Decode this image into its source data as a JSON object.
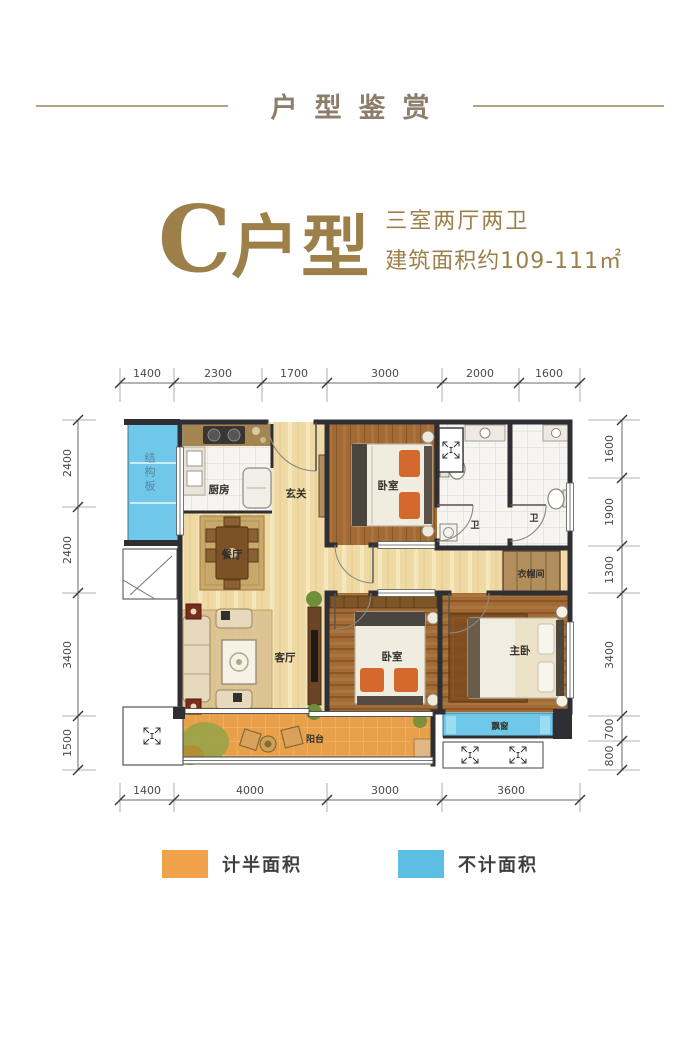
{
  "header": {
    "title": "户型鉴赏"
  },
  "unit": {
    "series": "C",
    "type_word": "户型",
    "layout": "三室两厅两卫",
    "area": "建筑面积约109-111㎡"
  },
  "plan": {
    "rooms": {
      "kitchen": "厨房",
      "foyer": "玄关",
      "dining": "餐厅",
      "living": "客厅",
      "bedroom1": "卧室",
      "bedroom2": "卧室",
      "master": "主卧",
      "bath1": "卫",
      "bath2": "卫",
      "closet": "衣帽间",
      "balcony": "阳台",
      "bay_window": "飘窗",
      "structure_board": "结构板"
    },
    "dims": {
      "top": [
        "1400",
        "2300",
        "1700",
        "3000",
        "2000",
        "1600"
      ],
      "bottom": [
        "1400",
        "4000",
        "3000",
        "3600"
      ],
      "left": [
        "2400",
        "2400",
        "3400",
        "1500"
      ],
      "right": [
        "1600",
        "1900",
        "1300",
        "3400",
        "700",
        "800"
      ]
    },
    "colors": {
      "wall": "#2F2E33",
      "light_wood": "#EFD9A5",
      "dark_wood": "#A26A35",
      "balcony_orange": "#E9A04B",
      "window_blue": "#6FC7E9"
    }
  },
  "legend": {
    "items": [
      {
        "label": "计半面积",
        "color": "#F0A24A"
      },
      {
        "label": "不计面积",
        "color": "#5BBEE2"
      }
    ]
  }
}
